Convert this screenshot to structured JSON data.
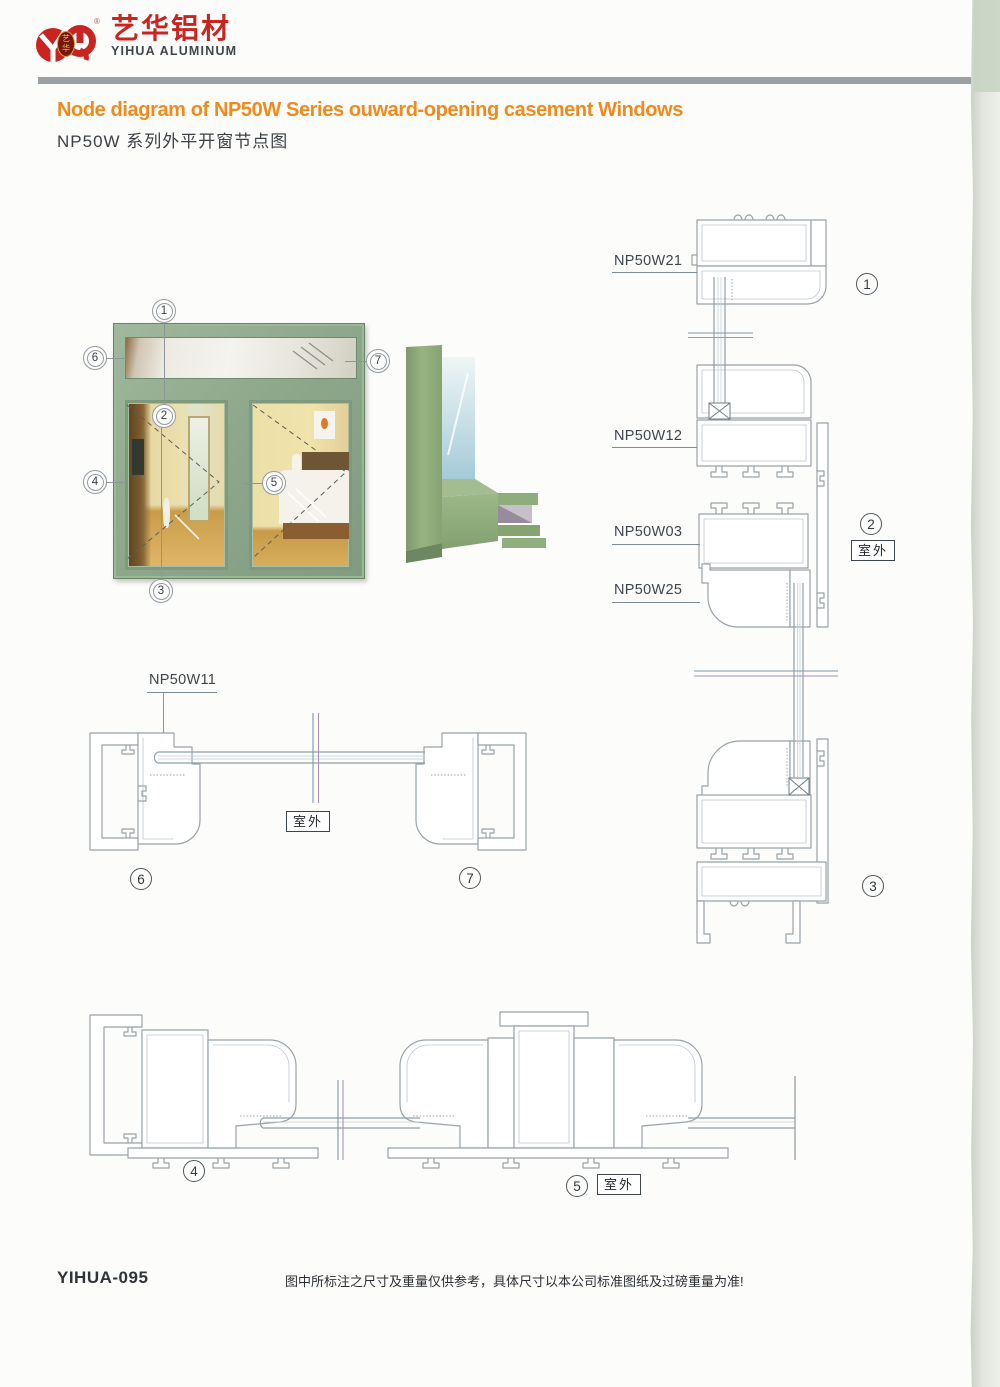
{
  "brand": {
    "logo_cn": "艺华铝材",
    "logo_en": "YIHUA ALUMINUM",
    "logo_mark_top": "艺",
    "logo_mark_bottom": "华",
    "registered_mark": "®"
  },
  "header": {
    "title_en": "Node diagram of NP50W Series ouward-opening casement Windows",
    "title_cn": "NP50W 系列外平开窗节点图"
  },
  "labels": {
    "np50w21": "NP50W21",
    "np50w12": "NP50W12",
    "np50w03": "NP50W03",
    "np50w25": "NP50W25",
    "np50w11": "NP50W11",
    "outdoor": "室外"
  },
  "callouts": {
    "c1": "1",
    "c2": "2",
    "c3": "3",
    "c4": "4",
    "c5": "5",
    "c6": "6",
    "c7": "7"
  },
  "footer": {
    "page_code": "YIHUA-095",
    "disclaimer": "图中所标注之尺寸及重量仅供参考，具体尺寸以本公司标准图纸及过磅重量为准!"
  },
  "colors": {
    "accent_orange": "#f08a1d",
    "brand_red": "#c9241f",
    "frame_green": "#8ea88c",
    "drawing_line": "#98a3a8",
    "divider_gray": "#9ba0a3"
  }
}
